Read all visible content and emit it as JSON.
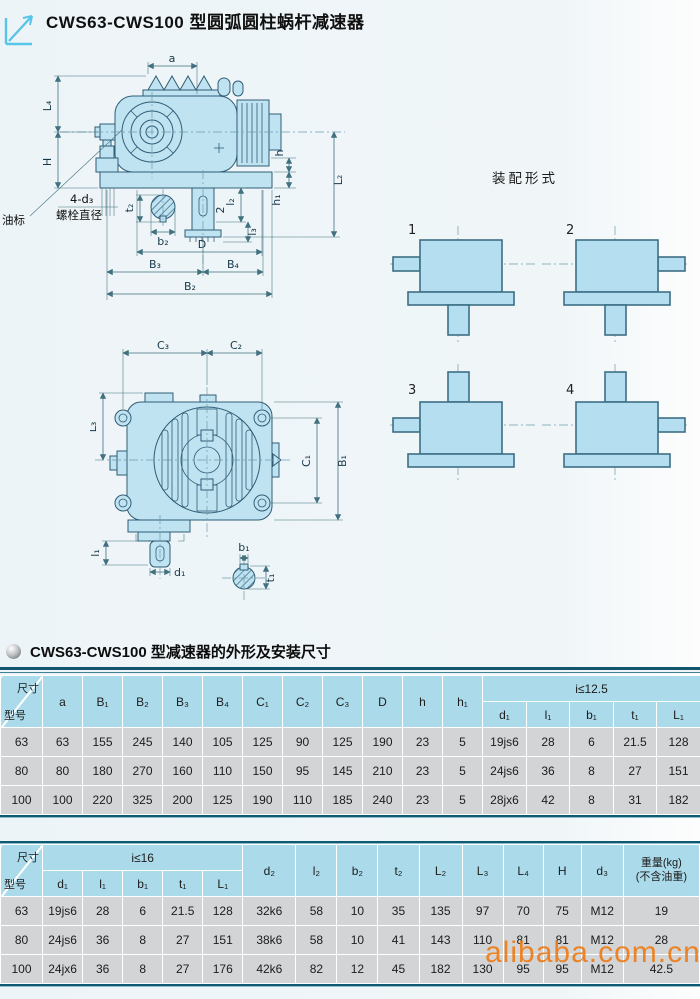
{
  "page": {
    "title": "CWS63-CWS100 型圆弧圆柱蜗杆减速器",
    "section_title": "CWS63-CWS100 型减速器的外形及安装尺寸",
    "watermark": "alibaba.com.cn"
  },
  "drawing1": {
    "labels": {
      "a": "a",
      "L4": "L₄",
      "H": "H",
      "h": "h",
      "h1": "h₁",
      "L2": "L₂",
      "l2": "l₂",
      "two": "2",
      "l3": "l₃",
      "t2": "t₂",
      "b2": "b₂",
      "D": "D",
      "B3": "B₃",
      "B4": "B₄",
      "B2": "B₂",
      "bolt_line1": "4-d₃",
      "bolt_line2": "螺栓直径",
      "oil": "油标"
    }
  },
  "drawing2": {
    "labels": {
      "C3": "C₃",
      "C2": "C₂",
      "L3": "L₃",
      "C1": "C₁",
      "B1": "B₁",
      "l1": "l₁",
      "d1": "d₁",
      "b1": "b₁",
      "t1": "t₁"
    }
  },
  "assembly": {
    "title": "装配形式",
    "numbers": [
      "1",
      "2",
      "3",
      "4"
    ]
  },
  "table1": {
    "corner": {
      "top": "尺寸",
      "bottom": "型号"
    },
    "columns": [
      "a",
      "B₁",
      "B₂",
      "B₃",
      "B₄",
      "C₁",
      "C₂",
      "C₃",
      "D",
      "h",
      "h₁"
    ],
    "group_label": "i≤12.5",
    "group_columns": [
      "d₁",
      "l₁",
      "b₁",
      "t₁",
      "L₁"
    ],
    "rows": [
      {
        "model": "63",
        "values": [
          "63",
          "155",
          "245",
          "140",
          "105",
          "125",
          "90",
          "125",
          "190",
          "23",
          "5",
          "19js6",
          "28",
          "6",
          "21.5",
          "128"
        ]
      },
      {
        "model": "80",
        "values": [
          "80",
          "180",
          "270",
          "160",
          "110",
          "150",
          "95",
          "145",
          "210",
          "23",
          "5",
          "24js6",
          "36",
          "8",
          "27",
          "151"
        ]
      },
      {
        "model": "100",
        "values": [
          "100",
          "220",
          "325",
          "200",
          "125",
          "190",
          "110",
          "185",
          "240",
          "23",
          "5",
          "28jx6",
          "42",
          "8",
          "31",
          "182"
        ]
      }
    ]
  },
  "table2": {
    "corner": {
      "top": "尺寸",
      "bottom": "型号"
    },
    "group_label": "i≤16",
    "group_columns": [
      "d₁",
      "l₁",
      "b₁",
      "t₁",
      "L₁"
    ],
    "columns": [
      "d₂",
      "l₂",
      "b₂",
      "t₂",
      "L₂",
      "L₃",
      "L₄",
      "H",
      "d₃"
    ],
    "weight_label": [
      "重量(kg)",
      "(不含油重)"
    ],
    "rows": [
      {
        "model": "63",
        "values": [
          "19js6",
          "28",
          "6",
          "21.5",
          "128",
          "32k6",
          "58",
          "10",
          "35",
          "135",
          "97",
          "70",
          "75",
          "M12",
          "19"
        ]
      },
      {
        "model": "80",
        "values": [
          "24js6",
          "36",
          "8",
          "27",
          "151",
          "38k6",
          "58",
          "10",
          "41",
          "143",
          "110",
          "81",
          "81",
          "M12",
          "28"
        ]
      },
      {
        "model": "100",
        "values": [
          "24jx6",
          "36",
          "8",
          "27",
          "176",
          "42k6",
          "82",
          "12",
          "45",
          "182",
          "130",
          "95",
          "95",
          "M12",
          "42.5"
        ]
      }
    ]
  },
  "colors": {
    "drawing_fill": "#bfe3f1",
    "drawing_stroke": "#2f5d76",
    "table_header_bg": "#abdbea",
    "table_cell_bg": "#d2d4d6",
    "rule": "#0f5a73",
    "watermark": "#ee7d18",
    "accent_arrow": "#58c5e8"
  }
}
